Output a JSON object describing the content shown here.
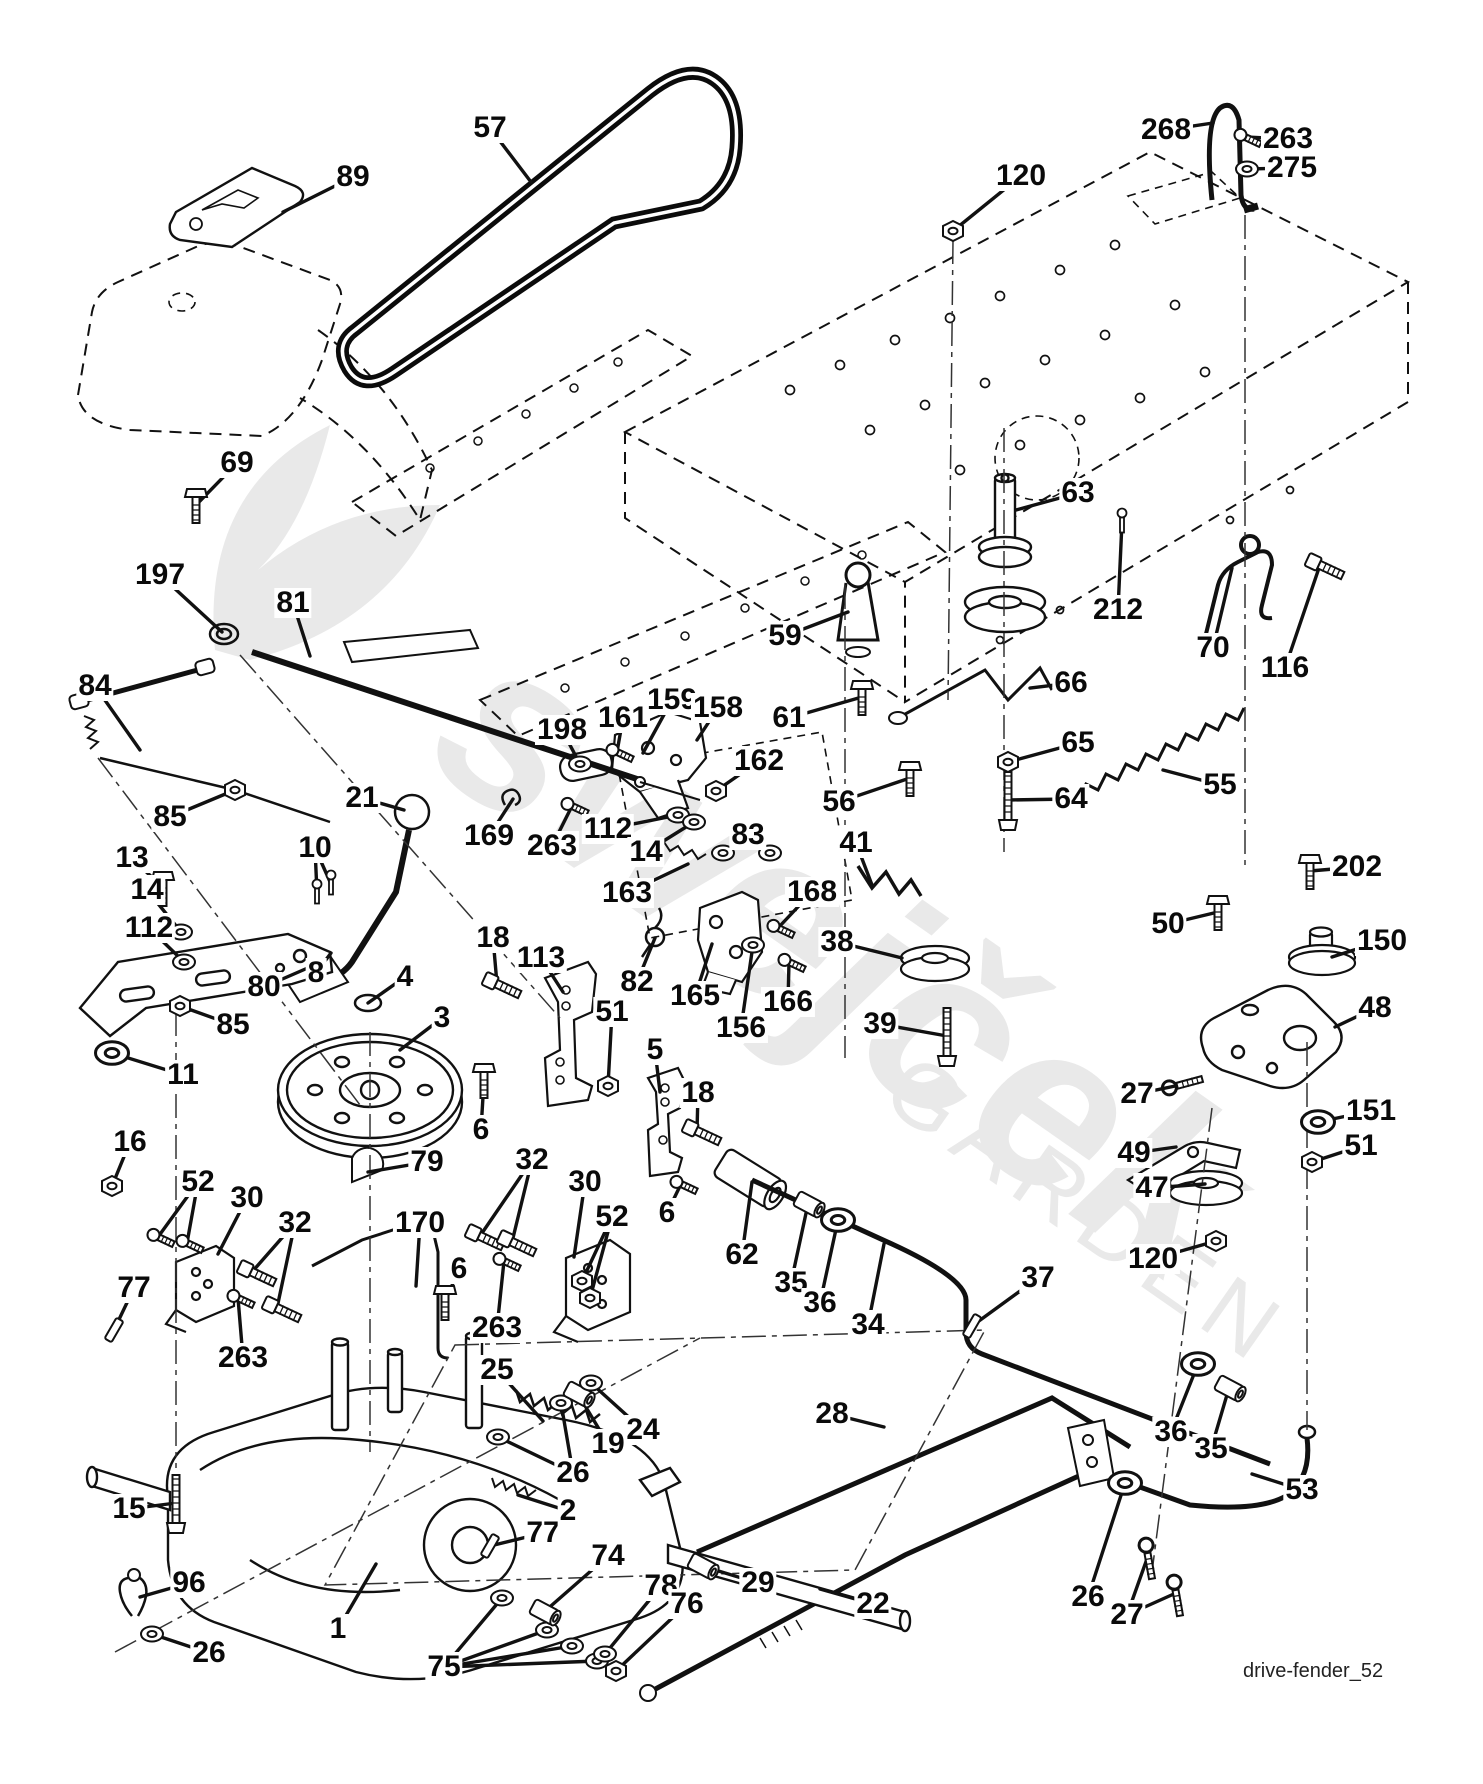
{
  "page": {
    "background": "#ffffff",
    "footer_label": "drive-fender_52"
  },
  "watermark": {
    "line1": "swejček",
    "line2": "GARDEN"
  },
  "diagram": {
    "description": "exploded parts diagram - drive / fender assembly"
  },
  "callouts": [
    {
      "label": "57",
      "x": 490,
      "y": 128,
      "targets": [
        [
          531,
          182
        ]
      ],
      "glyph": "none"
    },
    {
      "label": "89",
      "x": 353,
      "y": 177,
      "targets": [
        [
          283,
          212
        ]
      ],
      "glyph": "none"
    },
    {
      "label": "120",
      "x": 1021,
      "y": 176,
      "targets": [
        [
          953,
          231
        ]
      ],
      "glyph": "nut"
    },
    {
      "label": "268",
      "x": 1166,
      "y": 130,
      "targets": [
        [
          1213,
          123
        ]
      ],
      "glyph": "none"
    },
    {
      "label": "263",
      "x": 1288,
      "y": 139,
      "targets": [
        [
          1245,
          137
        ]
      ],
      "glyph": "screw"
    },
    {
      "label": "275",
      "x": 1292,
      "y": 168,
      "targets": [
        [
          1247,
          169
        ]
      ],
      "glyph": "washer"
    },
    {
      "label": "69",
      "x": 237,
      "y": 463,
      "targets": [
        [
          196,
          505
        ]
      ],
      "glyph": "boltv"
    },
    {
      "label": "197",
      "x": 160,
      "y": 575,
      "targets": [
        [
          222,
          632
        ]
      ],
      "glyph": "none"
    },
    {
      "label": "81",
      "x": 293,
      "y": 603,
      "targets": [
        [
          310,
          656
        ]
      ],
      "glyph": "none"
    },
    {
      "label": "63",
      "x": 1078,
      "y": 493,
      "targets": [
        [
          1016,
          510
        ]
      ],
      "glyph": "none"
    },
    {
      "label": "212",
      "x": 1118,
      "y": 610,
      "targets": [
        [
          1122,
          522
        ]
      ],
      "glyph": "screwv"
    },
    {
      "label": "70",
      "x": 1213,
      "y": 648,
      "targets": [
        [
          1232,
          568
        ]
      ],
      "glyph": "none"
    },
    {
      "label": "116",
      "x": 1285,
      "y": 668,
      "targets": [
        [
          1320,
          565
        ]
      ],
      "glyph": "bolt"
    },
    {
      "label": "59",
      "x": 785,
      "y": 636,
      "targets": [
        [
          848,
          612
        ]
      ],
      "glyph": "none"
    },
    {
      "label": "61",
      "x": 789,
      "y": 718,
      "targets": [
        [
          862,
          697
        ]
      ],
      "glyph": "boltv"
    },
    {
      "label": "56",
      "x": 839,
      "y": 802,
      "targets": [
        [
          910,
          778
        ]
      ],
      "glyph": "boltv"
    },
    {
      "label": "66",
      "x": 1071,
      "y": 683,
      "targets": [
        [
          1030,
          688
        ]
      ],
      "glyph": "none"
    },
    {
      "label": "65",
      "x": 1078,
      "y": 743,
      "targets": [
        [
          1008,
          762
        ]
      ],
      "glyph": "nut"
    },
    {
      "label": "64",
      "x": 1071,
      "y": 799,
      "targets": [
        [
          1008,
          800
        ]
      ],
      "glyph": "boltlong"
    },
    {
      "label": "55",
      "x": 1220,
      "y": 785,
      "targets": [
        [
          1163,
          770
        ]
      ],
      "glyph": "none"
    },
    {
      "label": "84",
      "x": 95,
      "y": 686,
      "targets": [
        [
          140,
          750
        ]
      ],
      "glyph": "none"
    },
    {
      "label": "85",
      "x": 170,
      "y": 817,
      "targets": [
        [
          235,
          790
        ]
      ],
      "glyph": "nut"
    },
    {
      "label": "21",
      "x": 362,
      "y": 798,
      "targets": [
        [
          404,
          810
        ]
      ],
      "glyph": "none"
    },
    {
      "label": "10",
      "x": 315,
      "y": 848,
      "targets": [
        [
          317,
          893
        ],
        [
          331,
          884
        ]
      ],
      "glyph": "screwv"
    },
    {
      "label": "169",
      "x": 489,
      "y": 836,
      "targets": [
        [
          513,
          799
        ]
      ],
      "glyph": "clip"
    },
    {
      "label": "198",
      "x": 562,
      "y": 730,
      "targets": [
        [
          580,
          764
        ]
      ],
      "glyph": "washer"
    },
    {
      "label": "161",
      "x": 623,
      "y": 718,
      "targets": [
        [
          617,
          752
        ]
      ],
      "glyph": "screw"
    },
    {
      "label": "159",
      "x": 672,
      "y": 700,
      "targets": [
        [
          643,
          753
        ]
      ],
      "glyph": "none"
    },
    {
      "label": "158",
      "x": 718,
      "y": 708,
      "targets": [
        [
          697,
          740
        ]
      ],
      "glyph": "none"
    },
    {
      "label": "162",
      "x": 759,
      "y": 761,
      "targets": [
        [
          716,
          791
        ]
      ],
      "glyph": "nut"
    },
    {
      "label": "112",
      "x": 608,
      "y": 829,
      "targets": [
        [
          678,
          815
        ]
      ],
      "glyph": "washer"
    },
    {
      "label": "14",
      "x": 646,
      "y": 852,
      "targets": [
        [
          694,
          822
        ]
      ],
      "glyph": "washer"
    },
    {
      "label": "83",
      "x": 748,
      "y": 835,
      "targets": [
        [
          723,
          853
        ],
        [
          770,
          853
        ]
      ],
      "glyph": "washer"
    },
    {
      "label": "163",
      "x": 627,
      "y": 893,
      "targets": [
        [
          688,
          864
        ]
      ],
      "glyph": "none"
    },
    {
      "label": "41",
      "x": 856,
      "y": 843,
      "targets": [
        [
          872,
          885
        ]
      ],
      "glyph": "none"
    },
    {
      "label": "168",
      "x": 812,
      "y": 892,
      "targets": [
        [
          778,
          928
        ]
      ],
      "glyph": "screw"
    },
    {
      "label": "38",
      "x": 837,
      "y": 942,
      "targets": [
        [
          902,
          958
        ]
      ],
      "glyph": "none"
    },
    {
      "label": "39",
      "x": 880,
      "y": 1024,
      "targets": [
        [
          947,
          1036
        ]
      ],
      "glyph": "boltlong"
    },
    {
      "label": "165",
      "x": 695,
      "y": 996,
      "targets": [
        [
          712,
          944
        ]
      ],
      "glyph": "none"
    },
    {
      "label": "156",
      "x": 741,
      "y": 1028,
      "targets": [
        [
          753,
          945
        ]
      ],
      "glyph": "washer"
    },
    {
      "label": "166",
      "x": 788,
      "y": 1002,
      "targets": [
        [
          789,
          962
        ]
      ],
      "glyph": "screw"
    },
    {
      "label": "82",
      "x": 637,
      "y": 982,
      "targets": [
        [
          655,
          938
        ]
      ],
      "glyph": "none"
    },
    {
      "label": "202",
      "x": 1357,
      "y": 867,
      "targets": [
        [
          1310,
          871
        ]
      ],
      "glyph": "boltv"
    },
    {
      "label": "50",
      "x": 1168,
      "y": 924,
      "targets": [
        [
          1218,
          912
        ]
      ],
      "glyph": "boltv"
    },
    {
      "label": "150",
      "x": 1382,
      "y": 941,
      "targets": [
        [
          1332,
          957
        ]
      ],
      "glyph": "none"
    },
    {
      "label": "48",
      "x": 1375,
      "y": 1008,
      "targets": [
        [
          1335,
          1027
        ]
      ],
      "glyph": "none"
    },
    {
      "label": "27",
      "x": 1137,
      "y": 1094,
      "targets": [
        [
          1180,
          1085
        ]
      ],
      "glyph": "eyebolt"
    },
    {
      "label": "151",
      "x": 1371,
      "y": 1111,
      "targets": [
        [
          1318,
          1122
        ]
      ],
      "glyph": "washerbig"
    },
    {
      "label": "51",
      "x": 1361,
      "y": 1146,
      "targets": [
        [
          1312,
          1162
        ]
      ],
      "glyph": "nut"
    },
    {
      "label": "49",
      "x": 1134,
      "y": 1153,
      "targets": [
        [
          1176,
          1147
        ]
      ],
      "glyph": "none"
    },
    {
      "label": "47",
      "x": 1152,
      "y": 1188,
      "targets": [
        [
          1205,
          1184
        ]
      ],
      "glyph": "none"
    },
    {
      "label": "80",
      "x": 264,
      "y": 987,
      "targets": [
        [
          310,
          967
        ]
      ],
      "glyph": "none"
    },
    {
      "label": "85",
      "x": 233,
      "y": 1025,
      "targets": [
        [
          180,
          1006
        ]
      ],
      "glyph": "nut"
    },
    {
      "label": "11",
      "x": 183,
      "y": 1075,
      "targets": [
        [
          112,
          1053
        ]
      ],
      "glyph": "washerbig"
    },
    {
      "label": "3",
      "x": 442,
      "y": 1018,
      "targets": [
        [
          400,
          1050
        ]
      ],
      "glyph": "none"
    },
    {
      "label": "4",
      "x": 405,
      "y": 977,
      "targets": [
        [
          368,
          1003
        ]
      ],
      "glyph": "ring"
    },
    {
      "label": "8",
      "x": 316,
      "y": 973,
      "targets": [
        [
          331,
          953
        ]
      ],
      "glyph": "none"
    },
    {
      "label": "13",
      "x": 132,
      "y": 858,
      "targets": [
        [
          163,
          888
        ]
      ],
      "glyph": "boltv"
    },
    {
      "label": "14",
      "x": 147,
      "y": 890,
      "targets": [
        [
          181,
          932
        ]
      ],
      "glyph": "washer"
    },
    {
      "label": "112",
      "x": 149,
      "y": 928,
      "targets": [
        [
          184,
          962
        ]
      ],
      "glyph": "washer"
    },
    {
      "label": "18",
      "x": 493,
      "y": 938,
      "targets": [
        [
          497,
          984
        ]
      ],
      "glyph": "bolt"
    },
    {
      "label": "113",
      "x": 541,
      "y": 958,
      "targets": [
        [
          563,
          992
        ]
      ],
      "glyph": "none"
    },
    {
      "label": "51",
      "x": 612,
      "y": 1012,
      "targets": [
        [
          608,
          1086
        ]
      ],
      "glyph": "nut"
    },
    {
      "label": "5",
      "x": 655,
      "y": 1050,
      "targets": [
        [
          660,
          1092
        ]
      ],
      "glyph": "none"
    },
    {
      "label": "18",
      "x": 698,
      "y": 1093,
      "targets": [
        [
          697,
          1131
        ]
      ],
      "glyph": "bolt"
    },
    {
      "label": "6",
      "x": 667,
      "y": 1213,
      "targets": [
        [
          681,
          1184
        ]
      ],
      "glyph": "screw"
    },
    {
      "label": "16",
      "x": 130,
      "y": 1142,
      "targets": [
        [
          112,
          1186
        ]
      ],
      "glyph": "nut"
    },
    {
      "label": "52",
      "x": 198,
      "y": 1182,
      "targets": [
        [
          158,
          1237
        ],
        [
          187,
          1243
        ]
      ],
      "glyph": "screw"
    },
    {
      "label": "30",
      "x": 247,
      "y": 1198,
      "targets": [
        [
          218,
          1254
        ]
      ],
      "glyph": "none"
    },
    {
      "label": "32",
      "x": 295,
      "y": 1223,
      "targets": [
        [
          252,
          1272
        ],
        [
          277,
          1308
        ]
      ],
      "glyph": "bolt"
    },
    {
      "label": "77",
      "x": 134,
      "y": 1288,
      "targets": [
        [
          114,
          1330
        ]
      ],
      "glyph": "key"
    },
    {
      "label": "263",
      "x": 243,
      "y": 1358,
      "targets": [
        [
          238,
          1298
        ]
      ],
      "glyph": "screw"
    },
    {
      "label": "170",
      "x": 420,
      "y": 1223,
      "targets": [
        [
          416,
          1286
        ]
      ],
      "glyph": "none"
    },
    {
      "label": "6",
      "x": 459,
      "y": 1269,
      "targets": [
        [
          445,
          1302
        ]
      ],
      "glyph": "boltv"
    },
    {
      "label": "32",
      "x": 532,
      "y": 1160,
      "targets": [
        [
          480,
          1236
        ],
        [
          512,
          1242
        ]
      ],
      "glyph": "bolt"
    },
    {
      "label": "30",
      "x": 585,
      "y": 1182,
      "targets": [
        [
          574,
          1257
        ]
      ],
      "glyph": "none"
    },
    {
      "label": "52",
      "x": 612,
      "y": 1217,
      "targets": [
        [
          582,
          1281
        ],
        [
          590,
          1298
        ]
      ],
      "glyph": "nut"
    },
    {
      "label": "263",
      "x": 497,
      "y": 1328,
      "targets": [
        [
          504,
          1261
        ]
      ],
      "glyph": "screw"
    },
    {
      "label": "6",
      "x": 481,
      "y": 1130,
      "targets": [
        [
          484,
          1080
        ]
      ],
      "glyph": "boltv"
    },
    {
      "label": "79",
      "x": 427,
      "y": 1162,
      "targets": [
        [
          368,
          1172
        ]
      ],
      "glyph": "none"
    },
    {
      "label": "62",
      "x": 742,
      "y": 1255,
      "targets": [
        [
          752,
          1182
        ]
      ],
      "glyph": "none"
    },
    {
      "label": "35",
      "x": 791,
      "y": 1283,
      "targets": [
        [
          808,
          1204
        ]
      ],
      "glyph": "spacer"
    },
    {
      "label": "36",
      "x": 820,
      "y": 1303,
      "targets": [
        [
          838,
          1220
        ]
      ],
      "glyph": "washerbig"
    },
    {
      "label": "34",
      "x": 868,
      "y": 1325,
      "targets": [
        [
          884,
          1244
        ]
      ],
      "glyph": "none"
    },
    {
      "label": "37",
      "x": 1038,
      "y": 1278,
      "targets": [
        [
          972,
          1326
        ]
      ],
      "glyph": "key"
    },
    {
      "label": "120",
      "x": 1153,
      "y": 1259,
      "targets": [
        [
          1216,
          1241
        ]
      ],
      "glyph": "nut"
    },
    {
      "label": "36",
      "x": 1171,
      "y": 1432,
      "targets": [
        [
          1198,
          1364
        ]
      ],
      "glyph": "washerbig"
    },
    {
      "label": "35",
      "x": 1211,
      "y": 1449,
      "targets": [
        [
          1229,
          1388
        ]
      ],
      "glyph": "spacer"
    },
    {
      "label": "53",
      "x": 1302,
      "y": 1490,
      "targets": [
        [
          1252,
          1474
        ]
      ],
      "glyph": "none"
    },
    {
      "label": "26",
      "x": 1088,
      "y": 1597,
      "targets": [
        [
          1125,
          1483
        ]
      ],
      "glyph": "washerbig"
    },
    {
      "label": "27",
      "x": 1127,
      "y": 1615,
      "targets": [
        [
          1148,
          1556
        ],
        [
          1176,
          1593
        ]
      ],
      "glyph": "eyeboltv"
    },
    {
      "label": "28",
      "x": 832,
      "y": 1414,
      "targets": [
        [
          884,
          1427
        ]
      ],
      "glyph": "none"
    },
    {
      "label": "29",
      "x": 758,
      "y": 1583,
      "targets": [
        [
          702,
          1566
        ]
      ],
      "glyph": "spacer"
    },
    {
      "label": "22",
      "x": 873,
      "y": 1604,
      "targets": [
        [
          820,
          1589
        ]
      ],
      "glyph": "none"
    },
    {
      "label": "15",
      "x": 129,
      "y": 1509,
      "targets": [
        [
          176,
          1503
        ]
      ],
      "glyph": "boltlong"
    },
    {
      "label": "96",
      "x": 189,
      "y": 1583,
      "targets": [
        [
          140,
          1597
        ]
      ],
      "glyph": "none"
    },
    {
      "label": "26",
      "x": 209,
      "y": 1653,
      "targets": [
        [
          152,
          1634
        ]
      ],
      "glyph": "washer"
    },
    {
      "label": "1",
      "x": 338,
      "y": 1629,
      "targets": [
        [
          376,
          1564
        ]
      ],
      "glyph": "none"
    },
    {
      "label": "75",
      "x": 444,
      "y": 1667,
      "targets": [
        [
          502,
          1598
        ],
        [
          547,
          1630
        ],
        [
          572,
          1646
        ],
        [
          597,
          1661
        ]
      ],
      "glyph": "washer"
    },
    {
      "label": "77",
      "x": 543,
      "y": 1533,
      "targets": [
        [
          490,
          1546
        ]
      ],
      "glyph": "key"
    },
    {
      "label": "25",
      "x": 497,
      "y": 1370,
      "targets": [
        [
          543,
          1421
        ]
      ],
      "glyph": "none"
    },
    {
      "label": "26",
      "x": 573,
      "y": 1473,
      "targets": [
        [
          498,
          1437
        ],
        [
          561,
          1403
        ]
      ],
      "glyph": "washer"
    },
    {
      "label": "19",
      "x": 608,
      "y": 1444,
      "targets": [
        [
          578,
          1394
        ]
      ],
      "glyph": "spacer"
    },
    {
      "label": "24",
      "x": 643,
      "y": 1430,
      "targets": [
        [
          591,
          1383
        ]
      ],
      "glyph": "washer"
    },
    {
      "label": "2",
      "x": 568,
      "y": 1511,
      "targets": [
        [
          518,
          1495
        ]
      ],
      "glyph": "none"
    },
    {
      "label": "74",
      "x": 608,
      "y": 1556,
      "targets": [
        [
          544,
          1612
        ]
      ],
      "glyph": "spacer"
    },
    {
      "label": "78",
      "x": 661,
      "y": 1586,
      "targets": [
        [
          605,
          1654
        ]
      ],
      "glyph": "washer"
    },
    {
      "label": "76",
      "x": 687,
      "y": 1604,
      "targets": [
        [
          616,
          1671
        ]
      ],
      "glyph": "nut"
    },
    {
      "label": "263",
      "x": 552,
      "y": 846,
      "targets": [
        [
          572,
          806
        ]
      ],
      "glyph": "screw"
    }
  ]
}
